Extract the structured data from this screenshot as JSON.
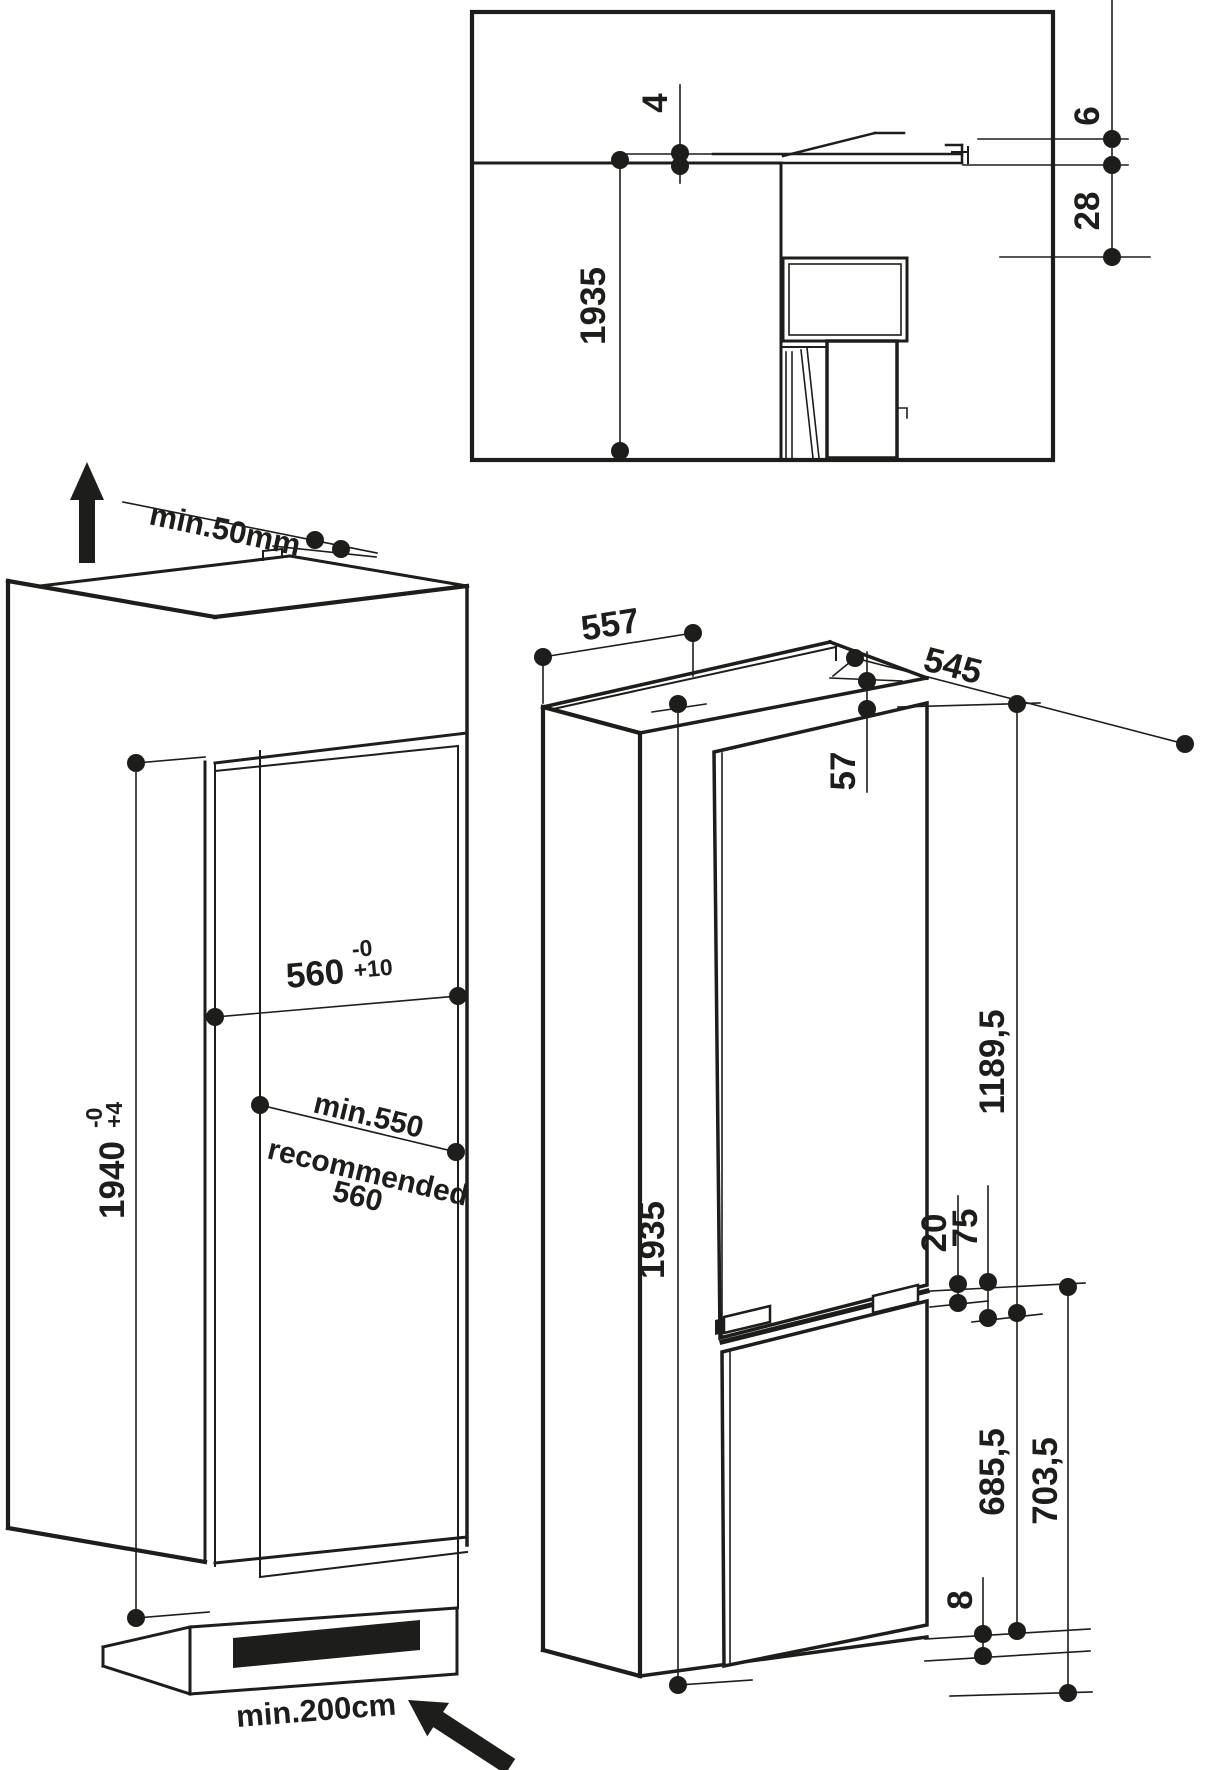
{
  "meta": {
    "title": "Built-in fridge-freezer installation dimension drawing"
  },
  "colors": {
    "line": "#1d1d1b",
    "background": "#ffffff"
  },
  "top_detail": {
    "gap_top": "4",
    "niche_height": "1935",
    "door_gap": "6",
    "recess_depth": "28"
  },
  "cabinet_view": {
    "top_clearance": "min.50mm",
    "niche_width": "560",
    "niche_width_tol_upper": "-0",
    "niche_width_tol_lower": "+10",
    "niche_depth_min": "min.550",
    "niche_depth_recommended_label": "recommended",
    "niche_depth_recommended_value": "560",
    "niche_height": "1940",
    "niche_height_tol_upper": "-0",
    "niche_height_tol_lower": "+4",
    "ventilation_area": "min.200cm"
  },
  "appliance_view": {
    "width": "557",
    "depth": "545",
    "top_offset": "57",
    "upper_door_height": "1189,5",
    "height": "1935",
    "door_gap": "20",
    "hinge_offset": "75",
    "lower_door_height": "685,5",
    "lower_section_height": "703,5",
    "bottom_gap": "8"
  }
}
